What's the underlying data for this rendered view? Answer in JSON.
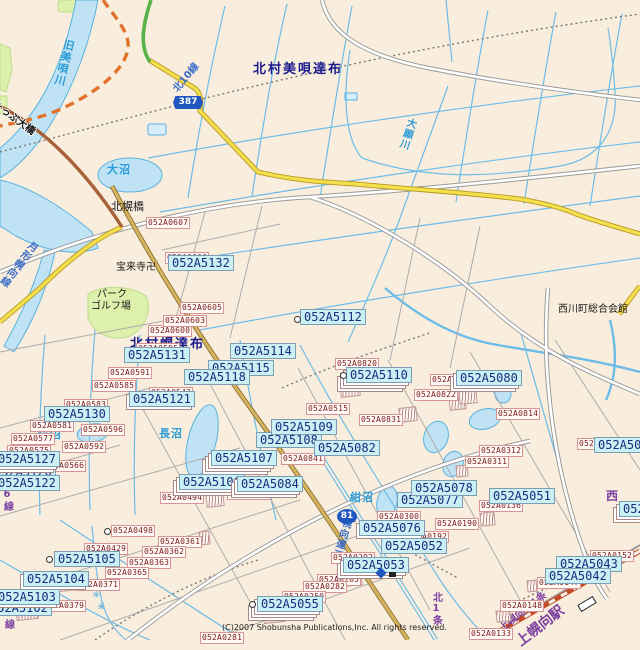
{
  "colors": {
    "bg": "#F9EEDD",
    "water_fill": "#BFE3F5",
    "water_line": "#58B2E0",
    "stream": "#6CBCE8",
    "thin_road": "#ACACAC",
    "road_case": "#9A9A9A",
    "yellow": "#F4E04E",
    "yellow_case": "#B89820",
    "tan": "#D2B45E",
    "brown": "#A7623A",
    "green_road": "#58B44A",
    "orange": "#E0722C",
    "rail": "#C44A24",
    "green_area": "#DDF0AC",
    "cyan_box_bg": "#C9F0F2",
    "cyan_box_text": "#1A2A80",
    "white_box_border": "#D69494",
    "white_box_text": "#7A1A1A",
    "navy_text": "#1A1A8C",
    "water_text": "#2B9CD8",
    "roadname_text": "#3A6CC8",
    "purple_text": "#7B3FA0",
    "accent_blue": "#2056C0"
  },
  "map": {
    "copyright": "(C)2007 Shobunsha Publications,Inc. All rights reserved.",
    "route_shields": [
      {
        "t": "387",
        "x": 173,
        "y": 96,
        "shape": "hex"
      },
      {
        "t": "81",
        "x": 337,
        "y": 509,
        "shape": "round"
      }
    ],
    "place_labels": [
      {
        "t": "北村美唄達布",
        "x": 253,
        "y": 63,
        "c": "navy",
        "s": 13
      },
      {
        "t": "北村幌達布",
        "x": 130,
        "y": 338,
        "c": "navy",
        "s": 13
      },
      {
        "t": "旧美唄川",
        "x": 64,
        "y": 38,
        "c": "wb",
        "s": 11,
        "v": 1,
        "r": 14
      },
      {
        "t": "北10線",
        "x": 172,
        "y": 88,
        "c": "rb",
        "s": 10,
        "r": -50
      },
      {
        "t": "大願川",
        "x": 406,
        "y": 116,
        "c": "wb",
        "s": 10,
        "v": 1,
        "r": 18
      },
      {
        "t": "たっぷ大橋",
        "x": -4,
        "y": 100,
        "c": "outl",
        "s": 10,
        "r": 36
      },
      {
        "t": "大沼",
        "x": 107,
        "y": 164,
        "c": "wb",
        "s": 11
      },
      {
        "t": "北幌橋",
        "x": 111,
        "y": 201,
        "c": "bk",
        "s": 11
      },
      {
        "t": "宝来寺卍",
        "x": 116,
        "y": 263,
        "c": "bk",
        "s": 10
      },
      {
        "t": "パーク",
        "x": 97,
        "y": 290,
        "c": "bk",
        "s": 10
      },
      {
        "t": "ゴルフ場",
        "x": 91,
        "y": 302,
        "c": "bk",
        "s": 10
      },
      {
        "t": "月形幌向線",
        "x": 30,
        "y": 238,
        "c": "rb",
        "s": 10,
        "v": 1,
        "r": 38
      },
      {
        "t": "長沼",
        "x": 159,
        "y": 428,
        "c": "wb",
        "s": 11
      },
      {
        "t": "猫沼",
        "x": 38,
        "y": 429,
        "c": "wb",
        "s": 11
      },
      {
        "t": "紺沼",
        "x": 350,
        "y": 492,
        "c": "wb",
        "s": 11
      },
      {
        "t": "西川町総合会館",
        "x": 558,
        "y": 305,
        "c": "bk",
        "s": 10
      },
      {
        "t": "幌向運河",
        "x": 341,
        "y": 516,
        "c": "rb",
        "s": 10,
        "v": 1,
        "r": 16
      },
      {
        "t": "北6線",
        "x": 1,
        "y": 478,
        "c": "pp",
        "s": 10,
        "v": 1
      },
      {
        "t": "北5線",
        "x": 2,
        "y": 596,
        "c": "pp",
        "s": 10,
        "v": 1
      },
      {
        "t": "北1条",
        "x": 430,
        "y": 592,
        "c": "pp",
        "s": 10,
        "v": 1
      },
      {
        "t": "上幌向北1条",
        "x": 498,
        "y": 626,
        "c": "pp",
        "s": 10,
        "r": -38
      },
      {
        "t": "上幌向駅",
        "x": 514,
        "y": 638,
        "c": "pp",
        "s": 14,
        "r": -38
      },
      {
        "t": "西",
        "x": 606,
        "y": 490,
        "c": "pp",
        "s": 12
      }
    ],
    "cyan_labels": [
      {
        "t": "052A5132",
        "x": 168,
        "y": 255
      },
      {
        "t": "052A5112",
        "x": 300,
        "y": 309
      },
      {
        "t": "052A5114",
        "x": 230,
        "y": 343
      },
      {
        "t": "052A5115",
        "x": 208,
        "y": 360
      },
      {
        "t": "052A5118",
        "x": 184,
        "y": 369
      },
      {
        "t": "052A5131",
        "x": 124,
        "y": 347
      },
      {
        "t": "052A5121",
        "x": 129,
        "y": 391,
        "k": 1
      },
      {
        "t": "052A5130",
        "x": 44,
        "y": 406
      },
      {
        "t": "052A5120",
        "x": -10,
        "y": 464
      },
      {
        "t": "052A5127",
        "x": -6,
        "y": 451,
        "k": 2
      },
      {
        "t": "052A5122",
        "x": -6,
        "y": 475
      },
      {
        "t": "052A5110",
        "x": 346,
        "y": 367,
        "k": 3
      },
      {
        "t": "052A5080",
        "x": 456,
        "y": 370,
        "k": 2
      },
      {
        "t": "052A5108",
        "x": 256,
        "y": 432
      },
      {
        "t": "052A5109",
        "x": 271,
        "y": 419
      },
      {
        "t": "052A5082",
        "x": 314,
        "y": 440
      },
      {
        "t": "052A5107",
        "x": 211,
        "y": 450,
        "k": 3
      },
      {
        "t": "052A5106",
        "x": 179,
        "y": 474,
        "k": 2
      },
      {
        "t": "052A5084",
        "x": 237,
        "y": 476,
        "k": 2
      },
      {
        "t": "052A5105",
        "x": 54,
        "y": 551
      },
      {
        "t": "052A5104",
        "x": 23,
        "y": 571,
        "k": 1
      },
      {
        "t": "052A5102",
        "x": -14,
        "y": 600
      },
      {
        "t": "052A5103",
        "x": -6,
        "y": 589,
        "k": 1
      },
      {
        "t": "052A5076",
        "x": 359,
        "y": 520,
        "k": 1
      },
      {
        "t": "052A5052",
        "x": 381,
        "y": 538
      },
      {
        "t": "052A5053",
        "x": 343,
        "y": 557,
        "k": 2
      },
      {
        "t": "052A5055",
        "x": 257,
        "y": 596,
        "k": 3
      },
      {
        "t": "052A5077",
        "x": 397,
        "y": 492
      },
      {
        "t": "052A5078",
        "x": 411,
        "y": 480
      },
      {
        "t": "052A5051",
        "x": 489,
        "y": 488
      },
      {
        "t": "052A5043",
        "x": 556,
        "y": 556
      },
      {
        "t": "052A5042",
        "x": 545,
        "y": 568
      },
      {
        "t": "052A50",
        "x": 594,
        "y": 437
      },
      {
        "t": "052A",
        "x": 619,
        "y": 501,
        "k": 2
      }
    ],
    "white_labels": [
      {
        "t": "052A0607",
        "x": 146,
        "y": 217
      },
      {
        "t": "052A0606",
        "x": 165,
        "y": 252
      },
      {
        "t": "052A0605",
        "x": 180,
        "y": 302
      },
      {
        "t": "052A0600",
        "x": 148,
        "y": 325
      },
      {
        "t": "052A0603",
        "x": 163,
        "y": 315
      },
      {
        "t": "052A0595",
        "x": 136,
        "y": 343
      },
      {
        "t": "052A0591",
        "x": 108,
        "y": 367
      },
      {
        "t": "052A0585",
        "x": 92,
        "y": 380
      },
      {
        "t": "052A0542",
        "x": 149,
        "y": 387
      },
      {
        "t": "052A0583",
        "x": 64,
        "y": 399
      },
      {
        "t": "052A0581",
        "x": 30,
        "y": 420
      },
      {
        "t": "052A0577",
        "x": 11,
        "y": 433
      },
      {
        "t": "052A0575",
        "x": 7,
        "y": 445
      },
      {
        "t": "052A0596",
        "x": 81,
        "y": 424
      },
      {
        "t": "052A0592",
        "x": 62,
        "y": 441
      },
      {
        "t": "052A0566",
        "x": 42,
        "y": 460
      },
      {
        "t": "052A0820",
        "x": 335,
        "y": 358
      },
      {
        "t": "052A0515",
        "x": 306,
        "y": 403
      },
      {
        "t": "052A0831",
        "x": 359,
        "y": 414
      },
      {
        "t": "052A0822",
        "x": 414,
        "y": 389
      },
      {
        "t": "052A0817",
        "x": 430,
        "y": 374
      },
      {
        "t": "052A0814",
        "x": 496,
        "y": 408
      },
      {
        "t": "052A0841",
        "x": 281,
        "y": 453
      },
      {
        "t": "052A0842",
        "x": 227,
        "y": 488
      },
      {
        "t": "052A0494",
        "x": 160,
        "y": 492
      },
      {
        "t": "052A0498",
        "x": 111,
        "y": 525
      },
      {
        "t": "052A0429",
        "x": 84,
        "y": 543
      },
      {
        "t": "052A0361",
        "x": 158,
        "y": 536
      },
      {
        "t": "052A0362",
        "x": 142,
        "y": 546
      },
      {
        "t": "052A0363",
        "x": 127,
        "y": 557
      },
      {
        "t": "052A0365",
        "x": 105,
        "y": 567
      },
      {
        "t": "052A0371",
        "x": 76,
        "y": 579
      },
      {
        "t": "052A0379",
        "x": 42,
        "y": 600
      },
      {
        "t": "052A0300",
        "x": 377,
        "y": 511
      },
      {
        "t": "052A0190",
        "x": 435,
        "y": 518
      },
      {
        "t": "052A0192",
        "x": 405,
        "y": 531
      },
      {
        "t": "052A0292",
        "x": 331,
        "y": 552
      },
      {
        "t": "052A0205",
        "x": 317,
        "y": 574
      },
      {
        "t": "052A0282",
        "x": 303,
        "y": 581
      },
      {
        "t": "052A0250",
        "x": 282,
        "y": 591
      },
      {
        "t": "052A0281",
        "x": 200,
        "y": 632
      },
      {
        "t": "052A0312",
        "x": 479,
        "y": 445
      },
      {
        "t": "052A0311",
        "x": 465,
        "y": 456
      },
      {
        "t": "052A0136",
        "x": 479,
        "y": 500
      },
      {
        "t": "052A0147",
        "x": 537,
        "y": 577
      },
      {
        "t": "052A0148",
        "x": 500,
        "y": 600
      },
      {
        "t": "052A0133",
        "x": 469,
        "y": 628
      },
      {
        "t": "052A0152",
        "x": 590,
        "y": 550
      },
      {
        "t": "052A",
        "x": 577,
        "y": 438
      }
    ],
    "markers": [
      {
        "k": "circle",
        "x": 294,
        "y": 316
      },
      {
        "k": "circle",
        "x": 340,
        "y": 372
      },
      {
        "k": "circle",
        "x": 46,
        "y": 556
      },
      {
        "k": "circle",
        "x": 249,
        "y": 601
      },
      {
        "k": "circle",
        "x": 104,
        "y": 528
      },
      {
        "k": "diamond",
        "x": 377,
        "y": 569
      },
      {
        "k": "tiny",
        "x": 389,
        "y": 572
      },
      {
        "k": "station",
        "x": 578,
        "y": 600
      },
      {
        "k": "marsh",
        "x": 92,
        "y": 590
      },
      {
        "k": "marsh",
        "x": 97,
        "y": 602
      }
    ],
    "fans": [
      {
        "x": 399,
        "y": 407,
        "w": 16,
        "h": 13
      },
      {
        "x": 480,
        "y": 512,
        "w": 13,
        "h": 12
      },
      {
        "x": 199,
        "y": 531,
        "w": 9,
        "h": 12
      },
      {
        "x": 449,
        "y": 395,
        "w": 15,
        "h": 13
      },
      {
        "x": 344,
        "y": 570,
        "w": 16,
        "h": 14
      },
      {
        "x": 263,
        "y": 608,
        "w": 20,
        "h": 13
      },
      {
        "x": 206,
        "y": 492,
        "w": 16,
        "h": 13
      },
      {
        "x": 56,
        "y": 574,
        "w": 24,
        "h": 15
      },
      {
        "x": 16,
        "y": 605,
        "w": 20,
        "h": 13
      },
      {
        "x": 12,
        "y": 467,
        "w": 24,
        "h": 14
      },
      {
        "x": 496,
        "y": 610,
        "w": 13,
        "h": 10
      },
      {
        "x": 527,
        "y": 580,
        "w": 8,
        "h": 10
      },
      {
        "x": 456,
        "y": 465,
        "w": 10,
        "h": 10
      },
      {
        "x": 340,
        "y": 381,
        "w": 18,
        "h": 14
      },
      {
        "x": 459,
        "y": 389,
        "w": 16,
        "h": 13
      }
    ]
  }
}
